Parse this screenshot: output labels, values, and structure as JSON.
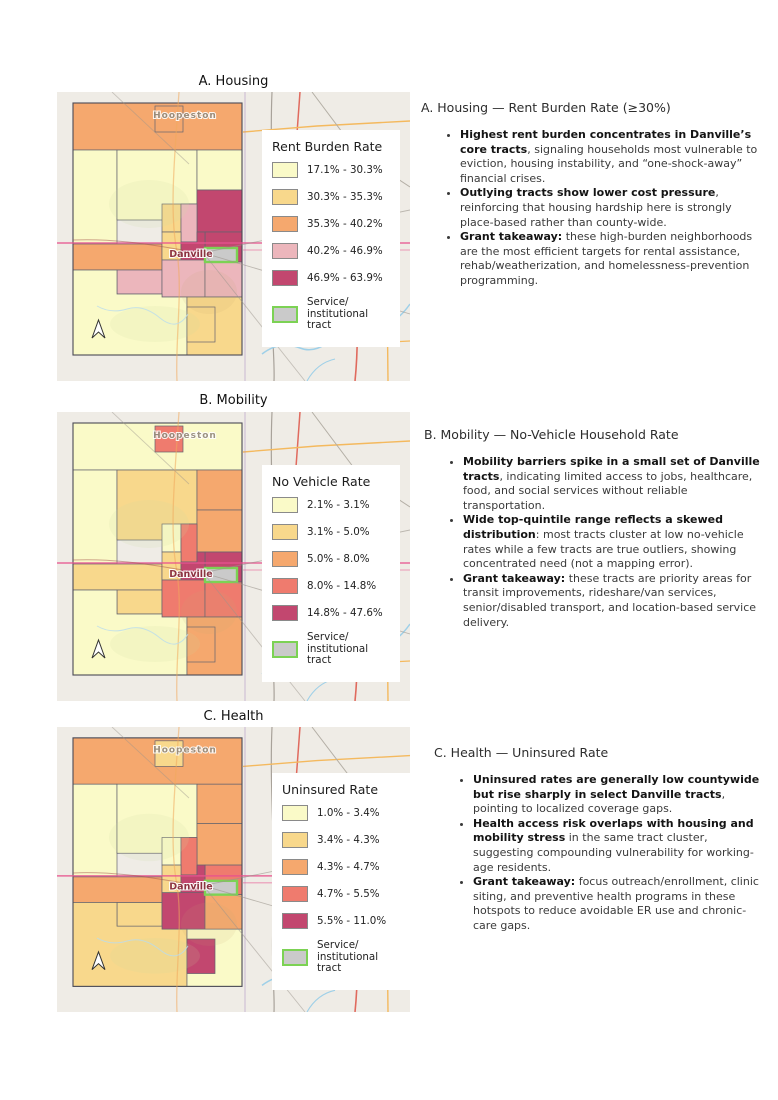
{
  "ramp": {
    "class1": "#FAFAC8",
    "class2": "#F8D88C",
    "class3": "#F5A86E",
    "class4_pink": "#ECB6BC",
    "class4_red": "#EF7B6E",
    "class5": "#C2476F",
    "service_fill": "#CACACA",
    "service_border": "#7CD254",
    "basemap": "#EFECE6"
  },
  "panels": [
    {
      "map_title": "A. Housing",
      "map_labels": {
        "north_city": "Hoopeston",
        "center_city": "Danville"
      },
      "legend": {
        "title": "Rent Burden Rate",
        "classes": [
          {
            "label": "17.1% - 30.3%",
            "color": "#FAFAC8"
          },
          {
            "label": "30.3% - 35.3%",
            "color": "#F8D88C"
          },
          {
            "label": "35.3% - 40.2%",
            "color": "#F5A86E"
          },
          {
            "label": "40.2% - 46.9%",
            "color": "#ECB6BC"
          },
          {
            "label": "46.9% - 63.9%",
            "color": "#C2476F"
          }
        ],
        "service": {
          "line1": "Service/",
          "line2": "institutional tract",
          "fill": "#CACACA",
          "border": "#7CD254"
        }
      },
      "annotation": {
        "heading": "A. Housing — Rent Burden Rate (≥30%)",
        "bullets": [
          {
            "bold": "Highest rent burden concentrates in Danville’s core tracts",
            "rest": ", signaling households most vulnerable to eviction, housing instability, and “one-shock-away” financial crises."
          },
          {
            "bold": "Outlying tracts show lower cost pressure",
            "rest": ", reinforcing that housing hardship here is strongly place-based rather than county-wide."
          },
          {
            "bold": "Grant takeaway:",
            "rest": " these high-burden neighborhoods are the most efficient targets for rental assistance, rehab/weatherization, and homelessness-prevention programming."
          }
        ]
      }
    },
    {
      "map_title": "B. Mobility",
      "map_labels": {
        "north_city": "Hoopeston",
        "center_city": "Danville"
      },
      "legend": {
        "title": "No Vehicle Rate",
        "classes": [
          {
            "label": "2.1% - 3.1%",
            "color": "#FAFAC8"
          },
          {
            "label": "3.1% - 5.0%",
            "color": "#F8D88C"
          },
          {
            "label": "5.0% - 8.0%",
            "color": "#F5A86E"
          },
          {
            "label": "8.0% - 14.8%",
            "color": "#EF7B6E"
          },
          {
            "label": "14.8% - 47.6%",
            "color": "#C2476F"
          }
        ],
        "service": {
          "line1": "Service/",
          "line2": "institutional tract",
          "fill": "#CACACA",
          "border": "#7CD254"
        }
      },
      "annotation": {
        "heading": "B. Mobility — No-Vehicle Household Rate",
        "bullets": [
          {
            "bold": "Mobility barriers spike in a small set of Danville tracts",
            "rest": ", indicating limited access to jobs, healthcare, food, and social services without reliable transportation."
          },
          {
            "bold": "Wide top-quintile range reflects a skewed distribution",
            "rest": ": most tracts cluster at low no-vehicle rates while a few tracts are true outliers, showing concentrated need (not a mapping error)."
          },
          {
            "bold": "Grant takeaway:",
            "rest": " these tracts are priority areas for transit improvements, rideshare/van services, senior/disabled transport, and location-based service delivery."
          }
        ]
      }
    },
    {
      "map_title": "C. Health",
      "map_labels": {
        "north_city": "Hoopeston",
        "center_city": "Danville"
      },
      "legend": {
        "title": "Uninsured Rate",
        "classes": [
          {
            "label": "1.0% - 3.4%",
            "color": "#FAFAC8"
          },
          {
            "label": "3.4% - 4.3%",
            "color": "#F8D88C"
          },
          {
            "label": "4.3% - 4.7%",
            "color": "#F5A86E"
          },
          {
            "label": "4.7% - 5.5%",
            "color": "#EF7B6E"
          },
          {
            "label": "5.5% - 11.0%",
            "color": "#C2476F"
          }
        ],
        "service": {
          "line1": "Service/",
          "line2": "institutional tract",
          "fill": "#CACACA",
          "border": "#7CD254"
        }
      },
      "annotation": {
        "heading": "C. Health — Uninsured Rate",
        "bullets": [
          {
            "bold": "Uninsured rates are generally low countywide but rise sharply in select Danville tracts",
            "rest": ", pointing to localized coverage gaps."
          },
          {
            "bold": "Health access risk overlaps with housing and mobility stress",
            "rest": " in the same tract cluster, suggesting compounding vulnerability for working-age residents."
          },
          {
            "bold": "Grant takeaway:",
            "rest": " focus outreach/enrollment, clinic siting, and preventive health programs in these hotspots to reduce avoidable ER use and chronic-care gaps."
          }
        ]
      }
    }
  ]
}
